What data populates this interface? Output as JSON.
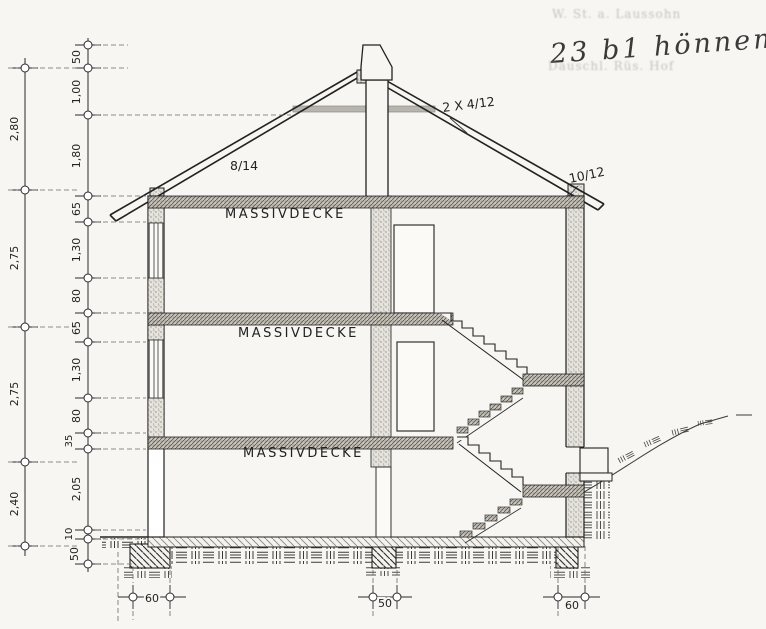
{
  "labels": {
    "slab": "MASSIVDECKE"
  },
  "roof_labels": {
    "rafter": "8/14",
    "battens": "2 X 4/12",
    "eave": "10/12"
  },
  "dimensions": {
    "outer": [
      "2,80",
      "2,75",
      "2,75",
      "2,40"
    ],
    "inner": [
      "50",
      "1,00",
      "1,80",
      "65",
      "1,30",
      "80",
      "65",
      "1,30",
      "80",
      "35",
      "2,05",
      "10",
      "50"
    ],
    "bottom": [
      "60",
      "50",
      "60"
    ]
  },
  "annotations": {
    "stamp_top": "W. St. a. Laussohn",
    "handwritten": "23 b1 hönnem",
    "stamp_bottom": "Dauschl. Rüs. Hof"
  }
}
